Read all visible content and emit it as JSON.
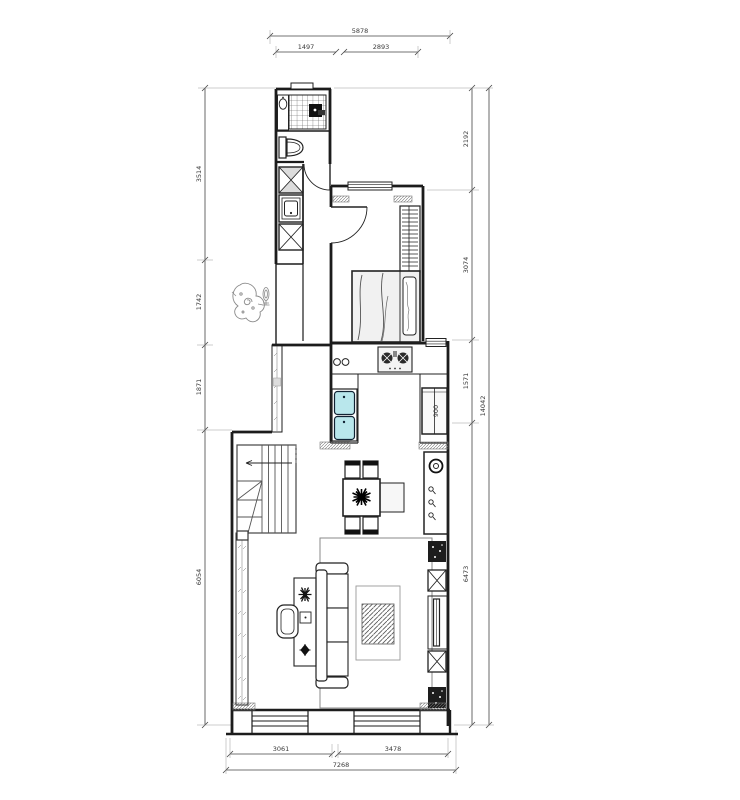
{
  "drawing": {
    "type": "apartment floor plan",
    "dims_top": {
      "total": "5878",
      "seg1": "1497",
      "seg2": "2893"
    },
    "dims_left": {
      "seg1": "3514",
      "seg2": "1742",
      "seg3": "1871",
      "seg4": "6054"
    },
    "dims_right": {
      "seg1": "2192",
      "seg2": "3074",
      "seg3": "1571",
      "seg4": "6473",
      "total": "14042"
    },
    "dims_bottom": {
      "seg1": "3061",
      "seg2": "3478",
      "total": "7268"
    },
    "labels": {
      "fridge_width": "900"
    },
    "colors": {
      "wall": "#1c1c1c",
      "dimension": "#444444",
      "sink_fill": "#b9e7ec"
    }
  }
}
